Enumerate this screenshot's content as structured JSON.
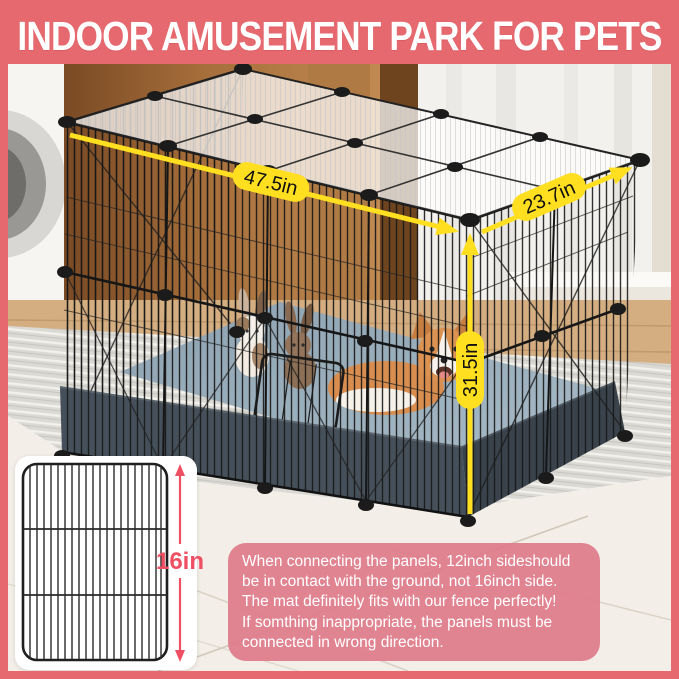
{
  "header": {
    "title": "INDOOR AMUSEMENT PARK FOR PETS"
  },
  "dimensions": {
    "width_label": "47.5in",
    "depth_label": "23.7in",
    "height_label": "31.5in",
    "panel_height_label": "16in"
  },
  "note": {
    "lines": [
      "When connecting the panels, 12inch sideshould",
      "be in contact with the ground, not 16inch side.",
      "The mat definitely fits with our fence perfectly!",
      "If somthing inappropriate, the panels must be",
      "connected in wrong direction."
    ]
  },
  "colors": {
    "frame_pink": "#e5696e",
    "note_pink": "#df7b8a",
    "arrow_yellow": "#ffdf1f",
    "accent_red": "#ef4f63",
    "mat_blue_grey": "#9bb0bd",
    "skirt_dark": "#46505a",
    "wire_black": "#171717"
  }
}
